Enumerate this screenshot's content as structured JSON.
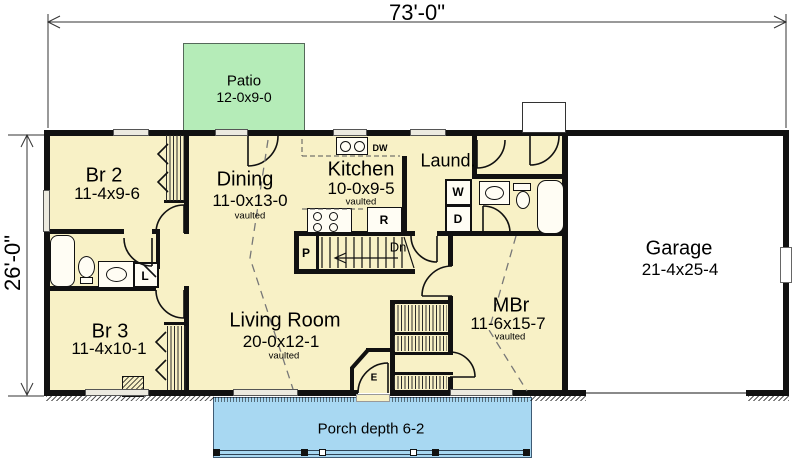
{
  "dimensions": {
    "width": "73'-0\"",
    "depth": "26'-0\""
  },
  "outdoor": {
    "patio": {
      "name": "Patio",
      "size": "12-0x9-0"
    },
    "porch": {
      "label": "Porch depth 6-2"
    }
  },
  "rooms": {
    "br2": {
      "name": "Br 2",
      "size": "11-4x9-6"
    },
    "dining": {
      "name": "Dining",
      "size": "11-0x13-0",
      "ceiling": "vaulted"
    },
    "kitchen": {
      "name": "Kitchen",
      "size": "10-0x9-5",
      "ceiling": "vaulted"
    },
    "laundry": {
      "name": "Laund."
    },
    "br3": {
      "name": "Br 3",
      "size": "11-4x10-1"
    },
    "living": {
      "name": "Living Room",
      "size": "20-0x12-1",
      "ceiling": "vaulted"
    },
    "mbr": {
      "name": "MBr",
      "size": "11-6x15-7",
      "ceiling": "vaulted"
    },
    "garage": {
      "name": "Garage",
      "size": "21-4x25-4"
    }
  },
  "fixtures": {
    "washer": "W",
    "dryer": "D",
    "refrigerator": "R",
    "dishwasher": "DW",
    "pantry": "P",
    "linen": "L",
    "entry": "E",
    "stairs_down": "Dn"
  },
  "colors": {
    "floor": "#f8f1c6",
    "patio": "#b5ecb8",
    "porch": "#a8d8f2",
    "wall": "#111111"
  }
}
